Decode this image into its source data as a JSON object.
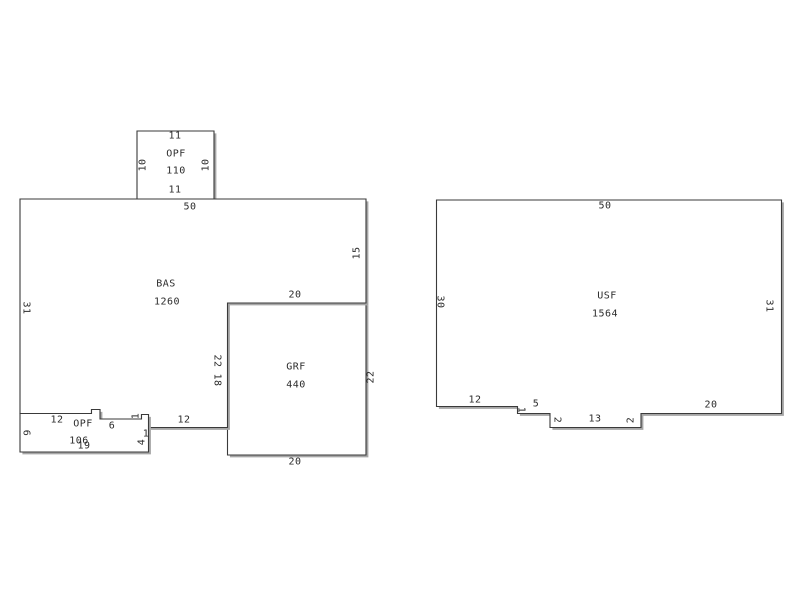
{
  "page": {
    "title": "Floor plan sketch",
    "background": "#ffffff"
  },
  "style": {
    "line_color": "#3a3a3a",
    "line_width": 1.1,
    "fill_color": "#ffffff",
    "shadow_color": "#a6a6a6",
    "shadow_offset": 2.4,
    "text_color": "#2b2b2b"
  },
  "floorplan": {
    "draw_order": [
      "grf",
      "opf_top",
      "bas",
      "opf_bottom",
      "usf"
    ],
    "areas": [
      {
        "id": "opf_top",
        "code": "OPF",
        "sqft": "110",
        "polygon": [
          [
            137,
            131
          ],
          [
            214,
            131
          ],
          [
            214,
            199.5
          ],
          [
            137,
            199.5
          ]
        ]
      },
      {
        "id": "grf",
        "code": "GRF",
        "sqft": "440",
        "polygon": [
          [
            227.5,
            303
          ],
          [
            366,
            303
          ],
          [
            366,
            455
          ],
          [
            227.5,
            455
          ]
        ]
      },
      {
        "id": "bas",
        "code": "BAS",
        "sqft": "1260",
        "polygon": [
          [
            20,
            199
          ],
          [
            366,
            199
          ],
          [
            366,
            303
          ],
          [
            227.5,
            303
          ],
          [
            227.5,
            427.5
          ],
          [
            148.5,
            427.5
          ],
          [
            148.5,
            414.5
          ],
          [
            141.5,
            414.5
          ],
          [
            141.5,
            419
          ],
          [
            100,
            419
          ],
          [
            100,
            409.5
          ],
          [
            91.5,
            409.5
          ],
          [
            91.5,
            413.5
          ],
          [
            20,
            413.5
          ]
        ]
      },
      {
        "id": "opf_bottom",
        "code": "OPF",
        "sqft": "106",
        "polygon": [
          [
            20,
            413.5
          ],
          [
            91.5,
            413.5
          ],
          [
            91.5,
            409.5
          ],
          [
            100,
            409.5
          ],
          [
            100,
            419
          ],
          [
            141.5,
            419
          ],
          [
            141.5,
            414.5
          ],
          [
            148.5,
            414.5
          ],
          [
            148.5,
            452
          ],
          [
            20,
            452
          ]
        ]
      },
      {
        "id": "usf",
        "code": "USF",
        "sqft": "1564",
        "polygon": [
          [
            436.5,
            200
          ],
          [
            781.5,
            200
          ],
          [
            781.5,
            413.5
          ],
          [
            641,
            413.5
          ],
          [
            641,
            427.5
          ],
          [
            550,
            427.5
          ],
          [
            550,
            413.5
          ],
          [
            517.5,
            413.5
          ],
          [
            517.5,
            406.5
          ],
          [
            436.5,
            406.5
          ]
        ]
      }
    ],
    "labels": [
      {
        "text": "11",
        "x": 175,
        "y": 136,
        "r": 0
      },
      {
        "text": "OPF",
        "x": 176,
        "y": 154,
        "r": 0
      },
      {
        "text": "110",
        "x": 176,
        "y": 171,
        "r": 0
      },
      {
        "text": "11",
        "x": 175,
        "y": 190,
        "r": 0
      },
      {
        "text": "10",
        "x": 143,
        "y": 165,
        "r": -90
      },
      {
        "text": "10",
        "x": 206,
        "y": 165,
        "r": -90
      },
      {
        "text": "50",
        "x": 190,
        "y": 207,
        "r": 0
      },
      {
        "text": "BAS",
        "x": 166,
        "y": 284,
        "r": 0
      },
      {
        "text": "1260",
        "x": 167,
        "y": 302,
        "r": 0
      },
      {
        "text": "31",
        "x": 26,
        "y": 308,
        "r": 90
      },
      {
        "text": "15",
        "x": 357,
        "y": 253,
        "r": -90
      },
      {
        "text": "20",
        "x": 295,
        "y": 295,
        "r": 0
      },
      {
        "text": "22",
        "x": 217,
        "y": 361,
        "r": 90
      },
      {
        "text": "18",
        "x": 217,
        "y": 380,
        "r": 90
      },
      {
        "text": "12",
        "x": 184,
        "y": 420,
        "r": 0
      },
      {
        "text": "12",
        "x": 57,
        "y": 420,
        "r": 0
      },
      {
        "text": "OPF",
        "x": 83,
        "y": 424,
        "r": 0
      },
      {
        "text": "6",
        "x": 112,
        "y": 426,
        "r": 0
      },
      {
        "text": "1",
        "x": 136,
        "y": 416,
        "r": -90
      },
      {
        "text": "106",
        "x": 79,
        "y": 441,
        "r": 0
      },
      {
        "text": "19",
        "x": 84,
        "y": 446,
        "r": 0
      },
      {
        "text": "6",
        "x": 26,
        "y": 433,
        "r": 90
      },
      {
        "text": "4",
        "x": 142,
        "y": 442,
        "r": -90
      },
      {
        "text": "1",
        "x": 146,
        "y": 434,
        "r": 0
      },
      {
        "text": "GRF",
        "x": 296,
        "y": 367,
        "r": 0
      },
      {
        "text": "440",
        "x": 296,
        "y": 385,
        "r": 0
      },
      {
        "text": "22",
        "x": 371,
        "y": 377,
        "r": -90
      },
      {
        "text": "20",
        "x": 295,
        "y": 462,
        "r": 0
      },
      {
        "text": "50",
        "x": 605,
        "y": 206,
        "r": 0
      },
      {
        "text": "USF",
        "x": 607,
        "y": 296,
        "r": 0
      },
      {
        "text": "1564",
        "x": 605,
        "y": 314,
        "r": 0
      },
      {
        "text": "30",
        "x": 440,
        "y": 302,
        "r": 90
      },
      {
        "text": "31",
        "x": 769,
        "y": 306,
        "r": 90
      },
      {
        "text": "12",
        "x": 475,
        "y": 400,
        "r": 0
      },
      {
        "text": "1",
        "x": 521,
        "y": 410,
        "r": 90
      },
      {
        "text": "5",
        "x": 536,
        "y": 404,
        "r": 0
      },
      {
        "text": "2",
        "x": 557,
        "y": 420,
        "r": 90
      },
      {
        "text": "13",
        "x": 595,
        "y": 419,
        "r": 0
      },
      {
        "text": "2",
        "x": 631,
        "y": 420,
        "r": -90
      },
      {
        "text": "20",
        "x": 711,
        "y": 405,
        "r": 0
      }
    ]
  }
}
